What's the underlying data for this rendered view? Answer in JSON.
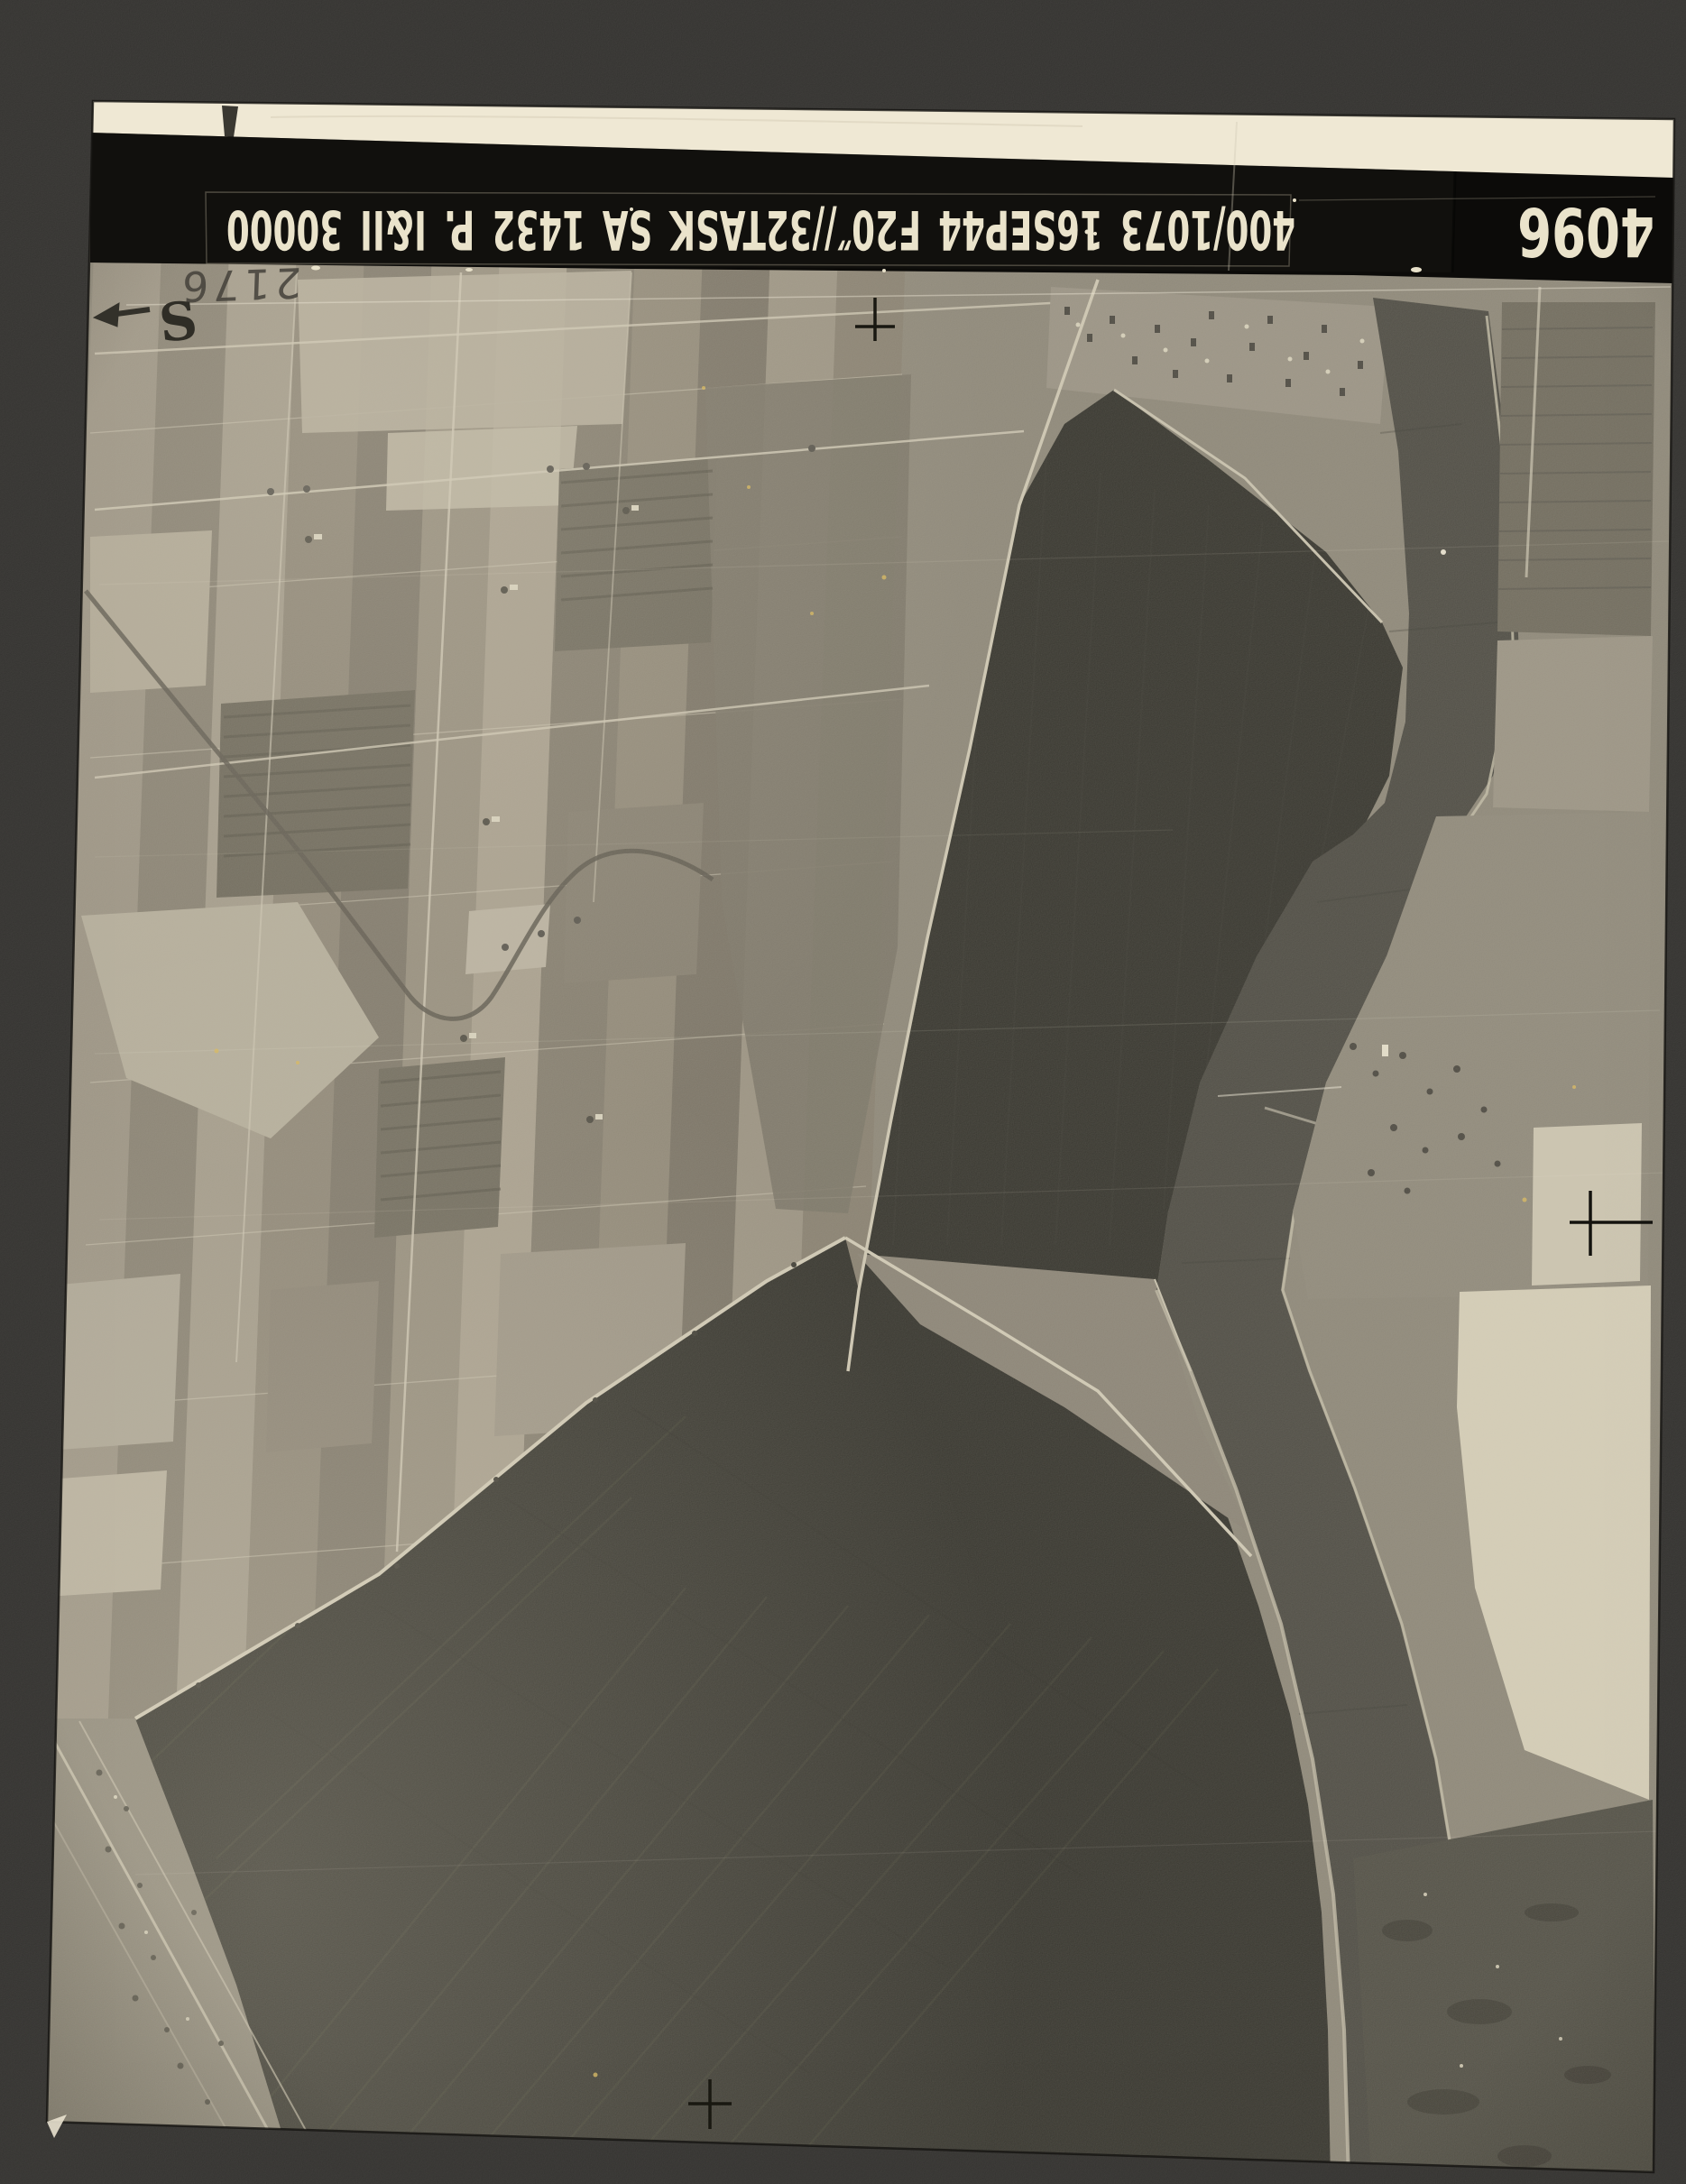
{
  "photo": {
    "stamp_text": "400/1073 16SEP44 F20″//32TASK SA 1432 P. I&II 30000",
    "print_number": "4096",
    "handwritten_number": "2176",
    "orientation_letter": "S"
  },
  "colors": {
    "mount_background": "#2f2e2c",
    "paper_edge_strip": "#efe8d4",
    "title_band": "#0c0b09",
    "stamp_ink": "#eae3cb",
    "field_midtone": "#8d8778",
    "flooded_polder": "#33322b",
    "river": "#4c4a42",
    "bright_field": "#d6cfb8",
    "dust_speck": "#d9b95c"
  }
}
